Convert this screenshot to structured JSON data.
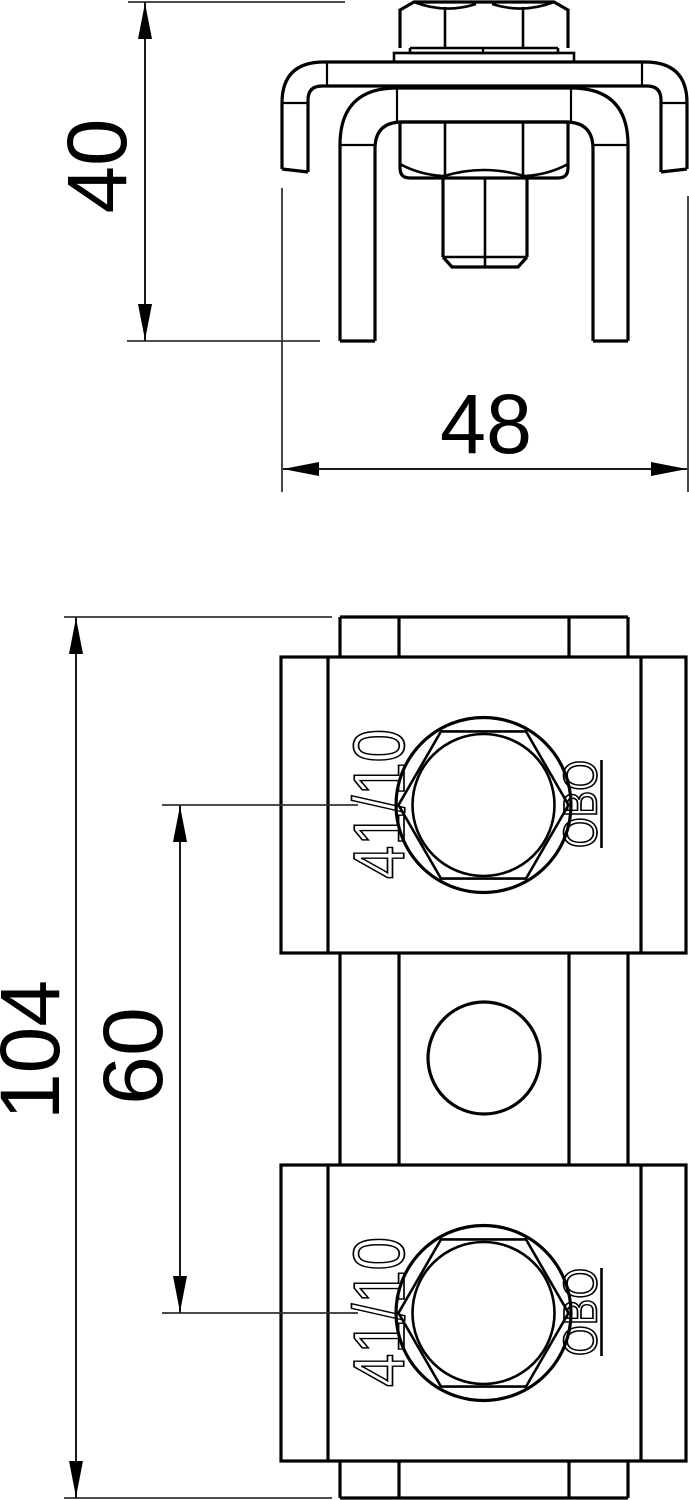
{
  "page": {
    "background": "#ffffff",
    "ink": "#000000"
  },
  "views": {
    "elevation": {
      "title": "front-elevation-of-rail-clamp",
      "dims": {
        "height": "40",
        "width": "48"
      }
    },
    "plan": {
      "title": "plan-view-of-rail-with-two-clamps",
      "dims": {
        "overall_length": "104",
        "bolt_spacing": "60"
      },
      "markings": {
        "bolt_size": "41/10",
        "brand": "OBO"
      }
    }
  }
}
